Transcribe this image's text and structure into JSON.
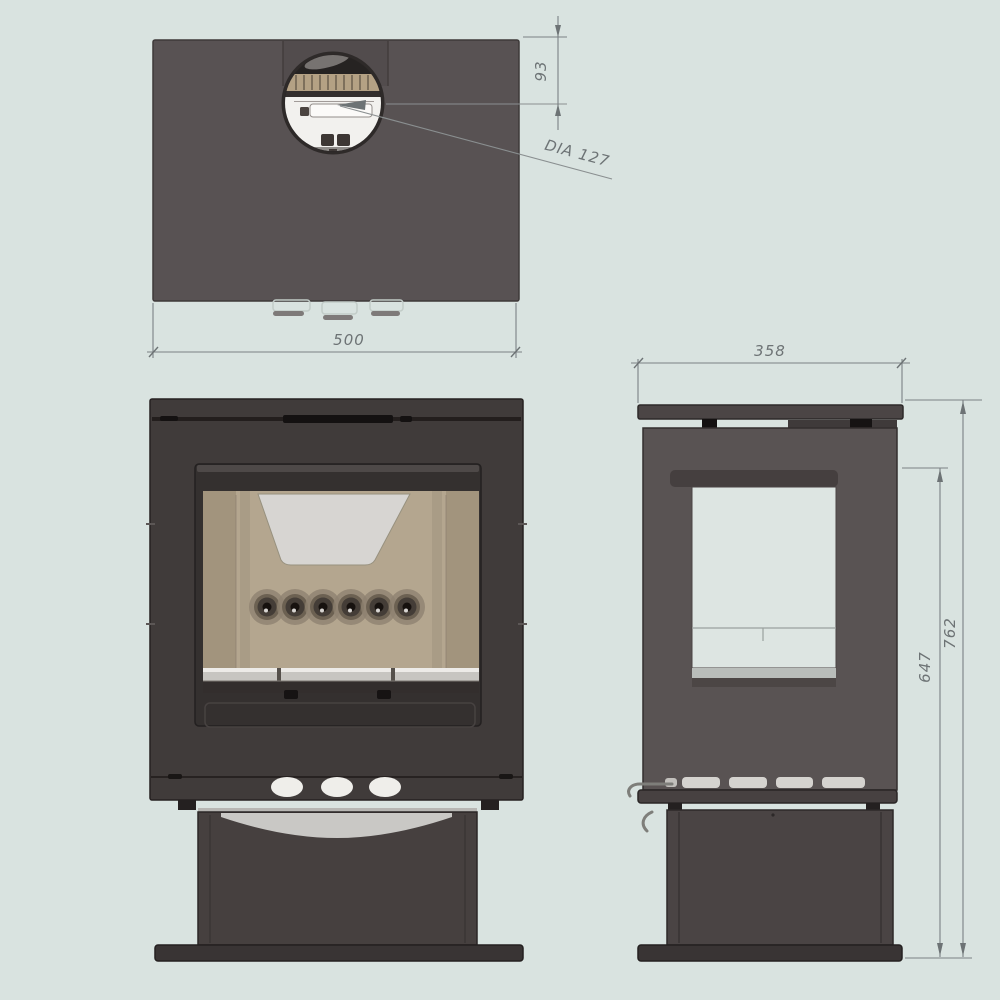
{
  "drawing": {
    "title": "wood-stove-technical-drawing",
    "views": {
      "top": {
        "name": "top-view"
      },
      "front": {
        "name": "front-view"
      },
      "side": {
        "name": "side-view"
      }
    },
    "dimensions": {
      "top_width": {
        "label": "500"
      },
      "flue_offset": {
        "label": "93"
      },
      "flue_diameter": {
        "label": "DIA 127"
      },
      "side_depth": {
        "label": "358"
      },
      "window_height": {
        "label": "647"
      },
      "overall_height": {
        "label": "762"
      }
    },
    "colors": {
      "background": "#d9e3e0",
      "top_body": "#585253",
      "front_body": "#403b3a",
      "door": "#34302f",
      "firebrick": "#b4a68f",
      "firebrick_side": "#a2947d",
      "baffle": "#d7d5d2",
      "retainer_bar": "#c7c5c1",
      "pedestal": "#46403f",
      "base_plate": "#393434",
      "side_body": "#595353",
      "flue_tan": "#b4a184",
      "flue_white": "#f2f1ee",
      "dimension": "#6d7375"
    }
  }
}
